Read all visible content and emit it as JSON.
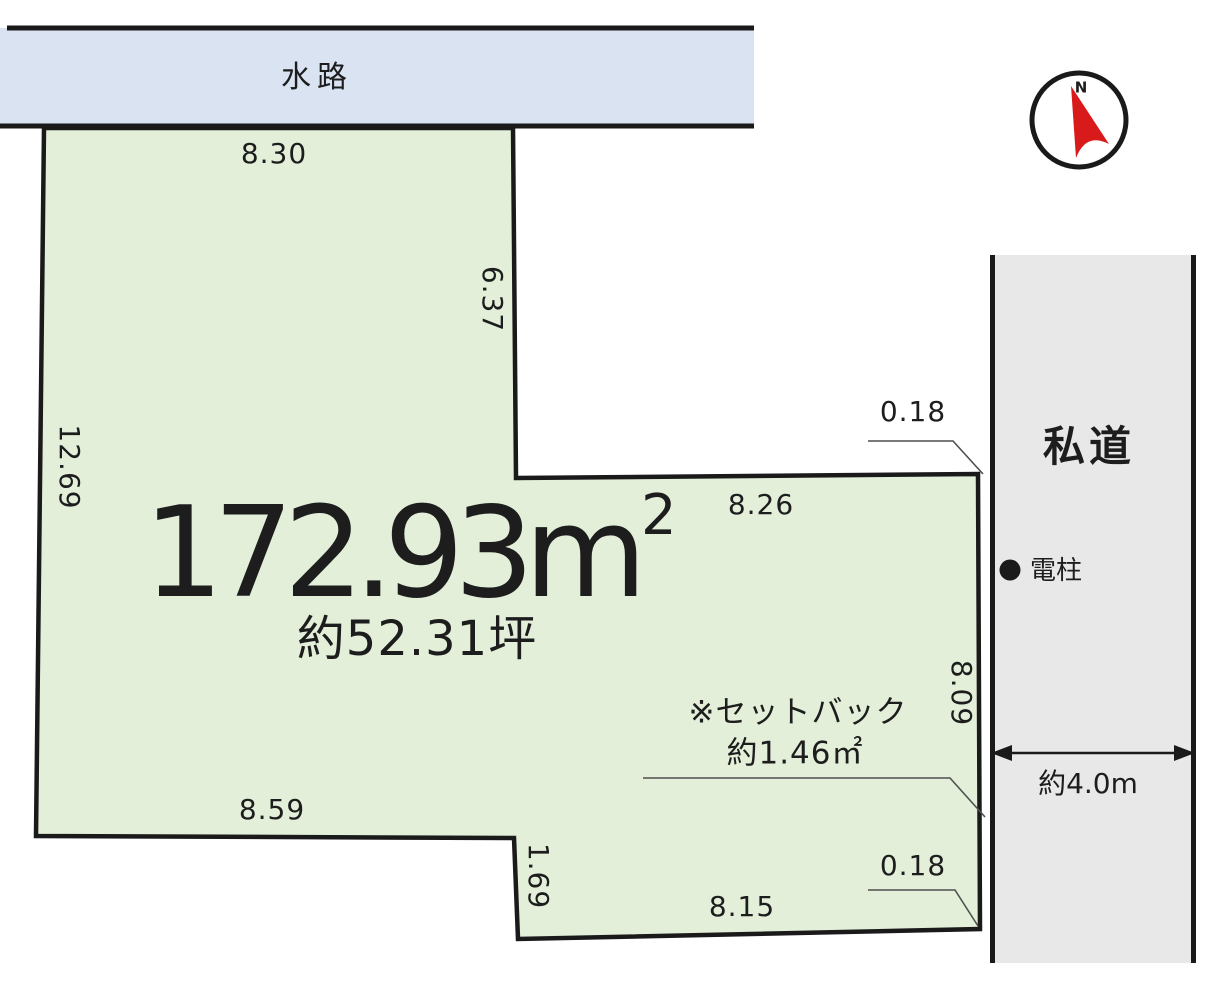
{
  "diagram": {
    "waterway_label": "水路",
    "road_label": "私道",
    "pole_label": "電柱",
    "area_m2": "172.93m",
    "area_m2_sup": "2",
    "area_tsubo": "約52.31坪",
    "setback_note_line1": "※セットバック",
    "setback_note_line2": "約1.46㎡",
    "road_width_label": "約4.0m",
    "compass_north": "N",
    "dims": {
      "top_edge": "8.30",
      "upper_right_edge": "6.37",
      "left_edge": "12.69",
      "middle_edge": "8.26",
      "right_edge": "8.09",
      "bottom_left_edge": "8.59",
      "step_edge": "1.69",
      "bottom_edge": "8.15",
      "offset_top": "0.18",
      "offset_bottom": "0.18"
    },
    "colors": {
      "plot_fill": "#e3efd9",
      "water_fill": "#d9e3f2",
      "road_fill": "#e8e8e8",
      "line": "#1a1a1a",
      "leader": "#4f4f4f",
      "north_red": "#d81a1a",
      "text": "#1d1d1d"
    }
  }
}
